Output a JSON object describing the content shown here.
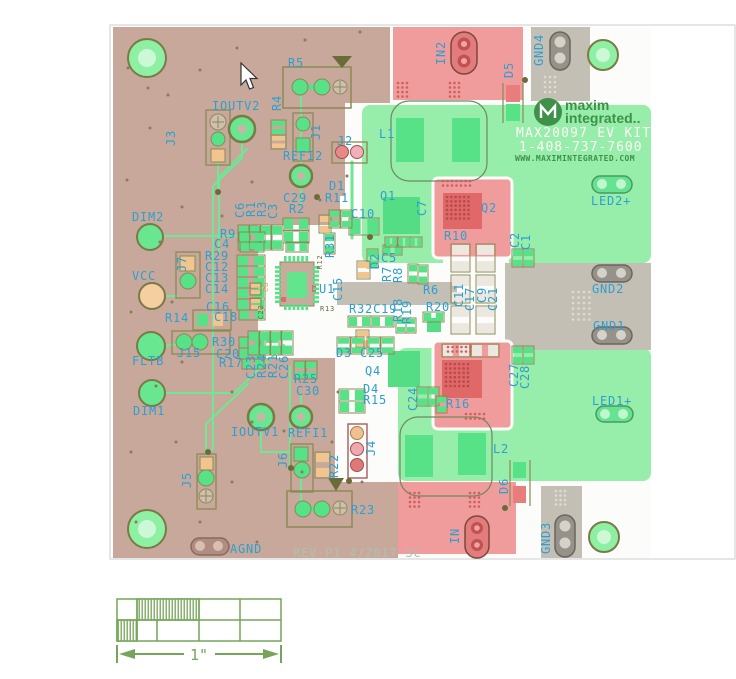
{
  "branding": {
    "kit_name": "MAX20097 EV KIT",
    "phone": "1-408-737-7600",
    "website": "WWW.MAXIMINTEGRATED.COM",
    "brand_top": "maxim",
    "brand_bottom": "integrated..",
    "rev_note": "REV-P1 4/2017 SC"
  },
  "scale_bar": {
    "label": "1\""
  },
  "colors": {
    "label_cyan": "#2e9fd0",
    "board_tan": "#c7a89b",
    "copper_green": "#97edaa",
    "pad_green": "#57e288",
    "block_red": "#f09c9c",
    "dark_red": "#e06868",
    "block_gray": "#c3bfb5",
    "silkscreen": "#8a8a55",
    "olive_dark": "#6b6b3a",
    "scale_green": "#74a558",
    "white_pad": "#ece8e0",
    "orange_pad": "#f2c58f",
    "text_white": "#fcfcf8",
    "web_green": "#3f9149",
    "rev_gray": "#b2bfae"
  },
  "labels": [
    {
      "t": "R5",
      "x": 288,
      "y": 67
    },
    {
      "t": "IOUTV2",
      "x": 212,
      "y": 110
    },
    {
      "t": "J2",
      "x": 337,
      "y": 145
    },
    {
      "t": "REFI2",
      "x": 283,
      "y": 160
    },
    {
      "t": "D1",
      "x": 329,
      "y": 190
    },
    {
      "t": "R11",
      "x": 325,
      "y": 202
    },
    {
      "t": "C29",
      "x": 283,
      "y": 202
    },
    {
      "t": "R2",
      "x": 289,
      "y": 213
    },
    {
      "t": "DIM2",
      "x": 132,
      "y": 221
    },
    {
      "t": "R9",
      "x": 220,
      "y": 238
    },
    {
      "t": "C4",
      "x": 214,
      "y": 248
    },
    {
      "t": "R29",
      "x": 205,
      "y": 260
    },
    {
      "t": "C12",
      "x": 205,
      "y": 271
    },
    {
      "t": "C13",
      "x": 205,
      "y": 282
    },
    {
      "t": "C14",
      "x": 205,
      "y": 293
    },
    {
      "t": "VCC",
      "x": 132,
      "y": 280
    },
    {
      "t": "C16",
      "x": 206,
      "y": 311
    },
    {
      "t": "C18",
      "x": 214,
      "y": 321
    },
    {
      "t": "R14",
      "x": 165,
      "y": 322
    },
    {
      "t": "R30",
      "x": 212,
      "y": 346
    },
    {
      "t": "C20",
      "x": 216,
      "y": 358
    },
    {
      "t": "R17",
      "x": 219,
      "y": 367
    },
    {
      "t": "J15",
      "x": 177,
      "y": 357
    },
    {
      "t": "FLTB",
      "x": 132,
      "y": 365
    },
    {
      "t": "DIM1",
      "x": 133,
      "y": 415
    },
    {
      "t": "R25",
      "x": 294,
      "y": 383
    },
    {
      "t": "C30",
      "x": 296,
      "y": 395
    },
    {
      "t": "IOUTV1",
      "x": 231,
      "y": 436
    },
    {
      "t": "REFI1",
      "x": 288,
      "y": 437
    },
    {
      "t": "R23",
      "x": 351,
      "y": 514
    },
    {
      "t": "AGND",
      "x": 230,
      "y": 553
    },
    {
      "t": "D3",
      "x": 336,
      "y": 357
    },
    {
      "t": "C25",
      "x": 360,
      "y": 357
    },
    {
      "t": "Q4",
      "x": 365,
      "y": 375
    },
    {
      "t": "D4",
      "x": 363,
      "y": 393
    },
    {
      "t": "R15",
      "x": 363,
      "y": 404
    },
    {
      "t": "R16",
      "x": 446,
      "y": 408
    },
    {
      "t": "L2",
      "x": 493,
      "y": 453
    },
    {
      "t": "LED1+",
      "x": 592,
      "y": 405
    },
    {
      "t": "GND1",
      "x": 593,
      "y": 330
    },
    {
      "t": "GND2",
      "x": 592,
      "y": 293
    },
    {
      "t": "R6",
      "x": 423,
      "y": 294
    },
    {
      "t": "R20",
      "x": 426,
      "y": 311
    },
    {
      "t": "R32C19",
      "x": 349,
      "y": 313
    },
    {
      "t": "U1",
      "x": 319,
      "y": 293
    },
    {
      "t": "C5",
      "x": 381,
      "y": 262
    },
    {
      "t": "C10",
      "x": 351,
      "y": 218
    },
    {
      "t": "Q1",
      "x": 380,
      "y": 200
    },
    {
      "t": "Q2",
      "x": 481,
      "y": 212
    },
    {
      "t": "R10",
      "x": 444,
      "y": 240
    },
    {
      "t": "LED2+",
      "x": 591,
      "y": 205
    },
    {
      "t": "L1",
      "x": 379,
      "y": 138
    },
    {
      "t": "R4",
      "x": 281,
      "y": 103,
      "v": 1
    },
    {
      "t": "J3",
      "x": 175,
      "y": 138,
      "v": 1
    },
    {
      "t": "J1",
      "x": 320,
      "y": 132,
      "v": 1
    },
    {
      "t": "C6",
      "x": 244,
      "y": 210,
      "v": 1
    },
    {
      "t": "R1",
      "x": 255,
      "y": 209,
      "v": 1
    },
    {
      "t": "R3",
      "x": 266,
      "y": 209,
      "v": 1
    },
    {
      "t": "C3",
      "x": 277,
      "y": 211,
      "v": 1
    },
    {
      "t": "J7",
      "x": 186,
      "y": 264,
      "v": 1
    },
    {
      "t": "C23",
      "x": 255,
      "y": 367,
      "v": 1
    },
    {
      "t": "R24",
      "x": 266,
      "y": 366,
      "v": 1
    },
    {
      "t": "R21",
      "x": 277,
      "y": 366,
      "v": 1
    },
    {
      "t": "C26",
      "x": 288,
      "y": 367,
      "v": 1
    },
    {
      "t": "J6",
      "x": 287,
      "y": 460,
      "v": 1
    },
    {
      "t": "J5",
      "x": 191,
      "y": 480,
      "v": 1
    },
    {
      "t": "R22",
      "x": 338,
      "y": 466,
      "v": 1
    },
    {
      "t": "J4",
      "x": 375,
      "y": 448,
      "v": 1
    },
    {
      "t": "C24",
      "x": 417,
      "y": 399,
      "v": 1
    },
    {
      "t": "D6",
      "x": 508,
      "y": 486,
      "v": 1
    },
    {
      "t": "IN",
      "x": 459,
      "y": 536,
      "v": 1
    },
    {
      "t": "GND3",
      "x": 550,
      "y": 538,
      "v": 1
    },
    {
      "t": "C27",
      "x": 518,
      "y": 375,
      "v": 1
    },
    {
      "t": "C28",
      "x": 529,
      "y": 377,
      "v": 1
    },
    {
      "t": "C11",
      "x": 463,
      "y": 295,
      "v": 1
    },
    {
      "t": "C17",
      "x": 474,
      "y": 299,
      "v": 1
    },
    {
      "t": "C9",
      "x": 486,
      "y": 295,
      "v": 1
    },
    {
      "t": "C21",
      "x": 497,
      "y": 299,
      "v": 1
    },
    {
      "t": "C2",
      "x": 519,
      "y": 240,
      "v": 1
    },
    {
      "t": "C1",
      "x": 530,
      "y": 242,
      "v": 1
    },
    {
      "t": "R18",
      "x": 402,
      "y": 310,
      "v": 1
    },
    {
      "t": "R19",
      "x": 411,
      "y": 312,
      "v": 1
    },
    {
      "t": "C15",
      "x": 342,
      "y": 289,
      "v": 1
    },
    {
      "t": "D2",
      "x": 379,
      "y": 261,
      "v": 1
    },
    {
      "t": "R7",
      "x": 391,
      "y": 274,
      "v": 1
    },
    {
      "t": "R8",
      "x": 402,
      "y": 275,
      "v": 1
    },
    {
      "t": "C7",
      "x": 426,
      "y": 208,
      "v": 1
    },
    {
      "t": "R31",
      "x": 334,
      "y": 246,
      "v": 1
    },
    {
      "t": "IN2",
      "x": 445,
      "y": 53,
      "v": 1
    },
    {
      "t": "D5",
      "x": 513,
      "y": 70,
      "v": 1
    },
    {
      "t": "GND4",
      "x": 543,
      "y": 50,
      "v": 1
    },
    {
      "t": "R12",
      "x": 322,
      "y": 262,
      "v": 1,
      "c": "dark",
      "s": 7
    },
    {
      "t": "R13",
      "x": 320,
      "y": 311,
      "c": "dark",
      "s": 7
    },
    {
      "t": "C22",
      "x": 263,
      "y": 312,
      "v": 1,
      "c": "dark",
      "s": 7
    },
    {
      "t": "C8",
      "x": 268,
      "y": 287,
      "v": 1,
      "c": "orange",
      "s": 7
    }
  ]
}
